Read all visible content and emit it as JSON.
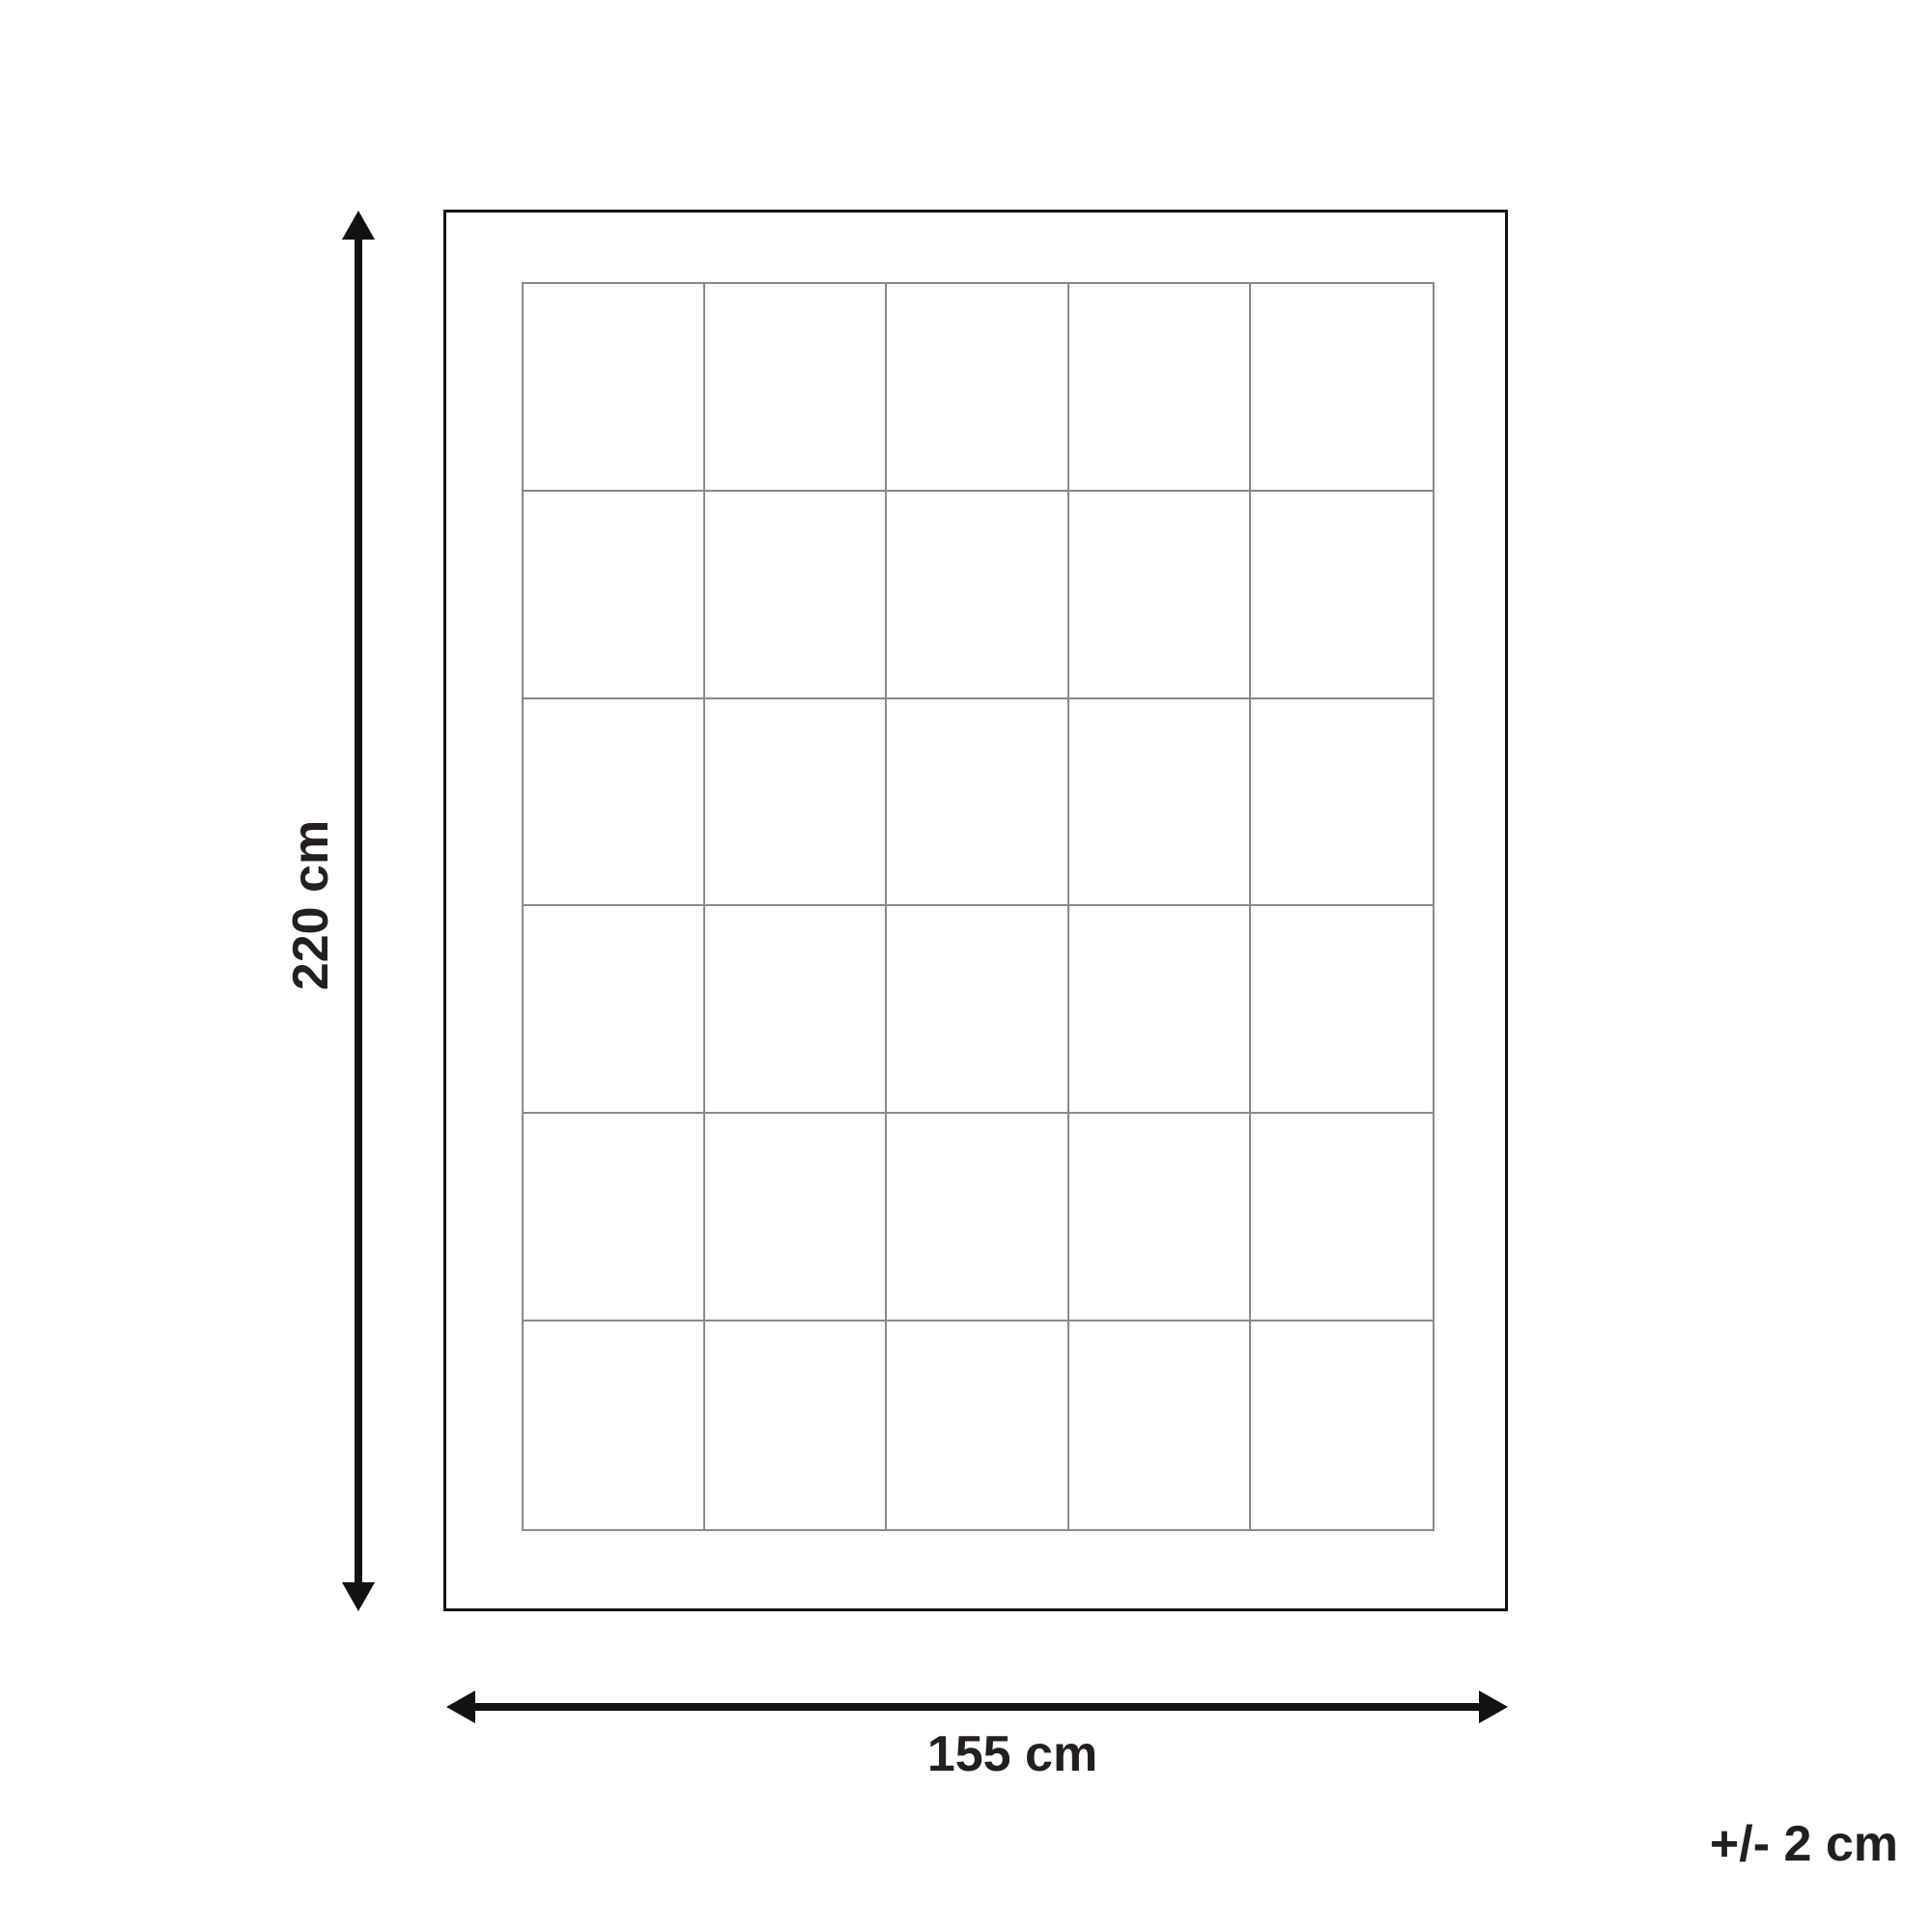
{
  "diagram": {
    "type": "product-dimensions",
    "height_label": "220 cm",
    "width_label": "155 cm",
    "tolerance_label": "+/- 2 cm",
    "grid": {
      "rows": 6,
      "columns": 5
    }
  },
  "colors": {
    "background": "#ffffff",
    "outline": "#121212",
    "arrow": "#121212",
    "grid_line": "#8a8a8a",
    "text": "#231f20"
  }
}
